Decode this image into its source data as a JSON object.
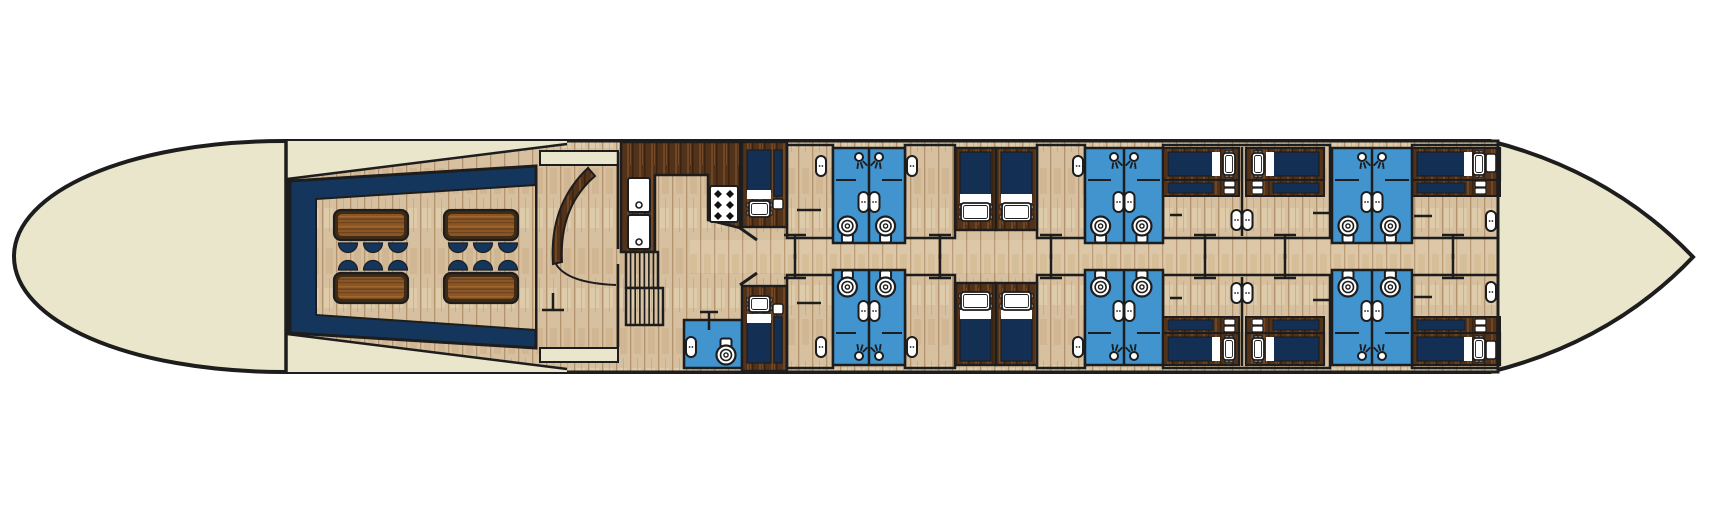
{
  "scene": {
    "width": 1720,
    "height": 514,
    "background": "#ffffff",
    "description": "river barge lower deck floor plan, no visible text"
  },
  "palette": {
    "outline": "#1d1d1d",
    "hull_cream": "#eae6cb",
    "navy": "#15365c",
    "mattress_navy": "#132f54",
    "bath_blue": "#4294ce",
    "wood_light": "#d6c0a0",
    "wood_corridor": "#dcc8a8",
    "wood_dark": "#53321a",
    "table_top": "#8a5627",
    "table_border": "#402b14",
    "fixture_white": "#ffffff"
  },
  "hull": {
    "outline_path": "M 285 141 C 128 141 14 192 14 256.5 C 14 321 128 372 285 372 L 1490 372 Q 1612 342 1693 257 Q 1612 172 1490 141 Z",
    "interior_rect": [
      287,
      141,
      1211,
      231
    ],
    "bulkhead_line": [
      286,
      141,
      286,
      372
    ],
    "stern_wall_line": [
      1498,
      141,
      1498,
      372
    ]
  },
  "bow_lounge": {
    "wedge_top": [
      [
        287,
        141
      ],
      [
        567,
        141
      ],
      [
        567,
        144
      ],
      [
        287,
        179
      ]
    ],
    "wedge_bottom": [
      [
        287,
        372
      ],
      [
        567,
        372
      ],
      [
        567,
        369
      ],
      [
        287,
        334
      ]
    ],
    "wedge_lines": [
      [
        287,
        179,
        567,
        144
      ],
      [
        287,
        334,
        567,
        369
      ]
    ],
    "wall_polygon": [
      [
        290,
        181
      ],
      [
        536,
        166
      ],
      [
        536,
        348
      ],
      [
        290,
        333
      ]
    ],
    "floor_polygon": [
      [
        316,
        199
      ],
      [
        536,
        185
      ],
      [
        536,
        330
      ],
      [
        316,
        315
      ]
    ],
    "cabinets": [
      [
        540,
        151,
        78,
        14
      ],
      [
        540,
        348,
        78,
        14
      ]
    ],
    "wall_lines": [
      [
        618,
        152,
        618,
        249
      ],
      [
        618,
        264,
        618,
        347
      ]
    ],
    "table_size": [
      74,
      30
    ],
    "tables": [
      [
        334,
        210
      ],
      [
        444,
        210
      ],
      [
        334,
        273
      ],
      [
        444,
        273
      ]
    ],
    "chairs": {
      "xs_left": [
        348,
        373,
        398
      ],
      "xs_right": [
        458,
        483,
        508
      ],
      "row_down_y": 243,
      "row_up_y": 270,
      "radius": 9.5
    },
    "door_arc_path": "M 588 168 Q 549 205 553 264 L 562 262 Q 559 207 595 176 Z",
    "swing_path": "M 556 264 Q 567 283 616 285",
    "door_tick": {
      "bar": [
        542,
        310,
        564,
        310
      ],
      "stem": [
        553,
        293,
        553,
        310
      ]
    }
  },
  "galley": {
    "counter_polygon": [
      [
        621,
        142
      ],
      [
        740,
        142
      ],
      [
        740,
        228
      ],
      [
        708,
        220
      ],
      [
        708,
        175
      ],
      [
        655,
        175
      ],
      [
        655,
        252
      ],
      [
        621,
        252
      ]
    ],
    "appliances": [
      [
        628,
        178,
        22,
        34
      ],
      [
        628,
        215,
        22,
        34
      ]
    ],
    "appliance_dots": [
      [
        639,
        205
      ],
      [
        639,
        242
      ]
    ],
    "stove": {
      "rect": [
        710,
        186,
        28,
        36
      ],
      "burner_cols": [
        718,
        730
      ],
      "burner_rows": [
        194,
        205,
        216
      ],
      "burner_r": 4
    },
    "stairs": [
      [
        626,
        252,
        32,
        36,
        6
      ],
      [
        626,
        288,
        37,
        37,
        7
      ]
    ],
    "diagonal_walls": [
      [
        740,
        228,
        757,
        240
      ],
      [
        740,
        285,
        757,
        273
      ]
    ],
    "wc": {
      "rect": [
        684,
        320,
        58,
        48
      ],
      "sink": [
        686,
        337
      ],
      "toilet_cx": 726,
      "toilet_cy": 355,
      "tank_up": true,
      "tick_bar": [
        700,
        312,
        718,
        312
      ],
      "tick_stem": [
        709,
        312,
        709,
        330
      ]
    }
  },
  "corridor": {
    "rect": [
      690,
      240,
      808,
      33
    ]
  },
  "cabin_wing": {
    "mirror_translate_y": 513,
    "floors": [
      [
        787,
        145,
        46,
        93
      ],
      [
        905,
        145,
        50,
        93
      ],
      [
        1037,
        145,
        48,
        93
      ],
      [
        1163,
        145,
        167,
        93
      ],
      [
        1412,
        145,
        86,
        93
      ]
    ],
    "partitions": [
      [
        1242,
        147,
        1242,
        236
      ]
    ],
    "single_bed": {
      "frame": [
        742,
        142,
        45,
        85
      ],
      "mattress": [
        747,
        150,
        24,
        42
      ],
      "fold": [
        747,
        190,
        24,
        9
      ],
      "pillow": [
        749,
        201,
        21,
        16
      ],
      "bench_navy": [
        774,
        150,
        8,
        46
      ],
      "bench_pad": [
        773,
        199,
        10,
        10
      ]
    },
    "twin_beds": [
      [
        955,
        148,
        41,
        82
      ],
      [
        996,
        148,
        41,
        82
      ]
    ],
    "bath_pairs": [
      {
        "x": 833,
        "w": 72
      },
      {
        "x": 1085,
        "w": 78
      },
      {
        "x": 1332,
        "w": 80
      }
    ],
    "bath_y": 148,
    "bath_h": 95,
    "toilet_fractions": [
      0.2,
      0.73
    ],
    "toilet_cy": 226,
    "wall_bed_cabins": [
      {
        "frame": [
          1163,
          148,
          76,
          32
        ],
        "mattress": [
          1168,
          152,
          45,
          24
        ],
        "fold": [
          1212,
          152,
          8,
          24
        ],
        "pillow": [
          1223,
          153,
          12,
          22
        ],
        "bench": [
          1163,
          180,
          76,
          16
        ],
        "bench_inset": [
          1168,
          183,
          45,
          10
        ],
        "pads": [
          [
            1224,
            181,
            11,
            6
          ],
          [
            1224,
            188,
            11,
            6
          ]
        ]
      },
      {
        "frame": [
          1246,
          148,
          78,
          32
        ],
        "mattress": [
          1273,
          152,
          46,
          24
        ],
        "fold": [
          1266,
          152,
          8,
          24
        ],
        "pillow": [
          1252,
          153,
          12,
          22
        ],
        "bench": [
          1246,
          180,
          78,
          16
        ],
        "bench_inset": [
          1273,
          183,
          46,
          10
        ],
        "pads": [
          [
            1252,
            181,
            11,
            6
          ],
          [
            1252,
            188,
            11,
            6
          ]
        ]
      },
      {
        "frame": [
          1412,
          148,
          88,
          32
        ],
        "mattress": [
          1417,
          152,
          48,
          24
        ],
        "fold": [
          1464,
          152,
          8,
          24
        ],
        "pillow": [
          1473,
          153,
          12,
          22
        ],
        "nightstand": [
          1486,
          154,
          10,
          18
        ],
        "bench": [
          1412,
          180,
          88,
          16
        ],
        "bench_inset": [
          1417,
          183,
          48,
          10
        ],
        "pads": [
          [
            1475,
            181,
            11,
            6
          ],
          [
            1475,
            188,
            11,
            6
          ]
        ]
      }
    ],
    "wall_sinks": [
      [
        816,
        156
      ],
      [
        907,
        156
      ],
      [
        1073,
        156
      ],
      [
        1486,
        211
      ]
    ],
    "door_ticks_x": [
      795,
      940,
      1051,
      1205,
      1285,
      1453
    ],
    "bath_door_ticks": [
      [
        797,
        821,
        210
      ],
      [
        1170,
        1182,
        215
      ],
      [
        1313,
        1331,
        213
      ],
      [
        1414,
        1432,
        216
      ]
    ]
  }
}
